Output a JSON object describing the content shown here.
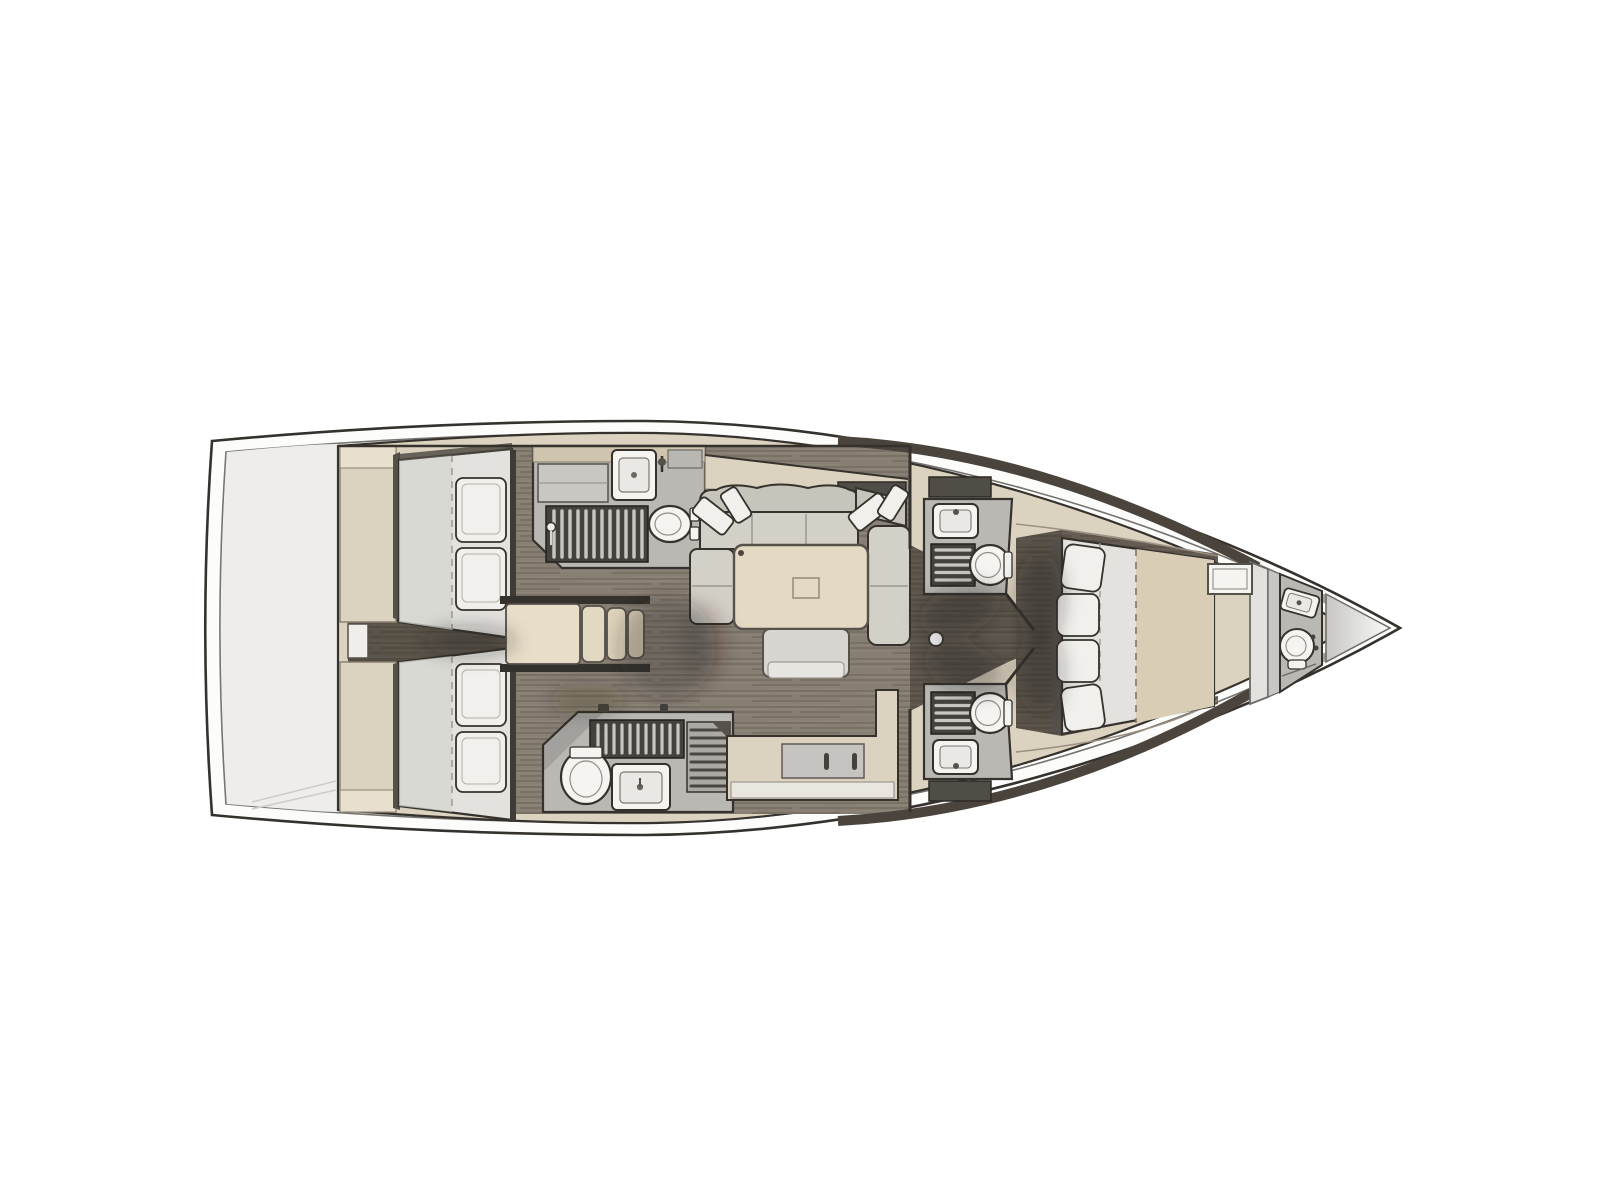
{
  "diagram": {
    "type": "yacht-interior-floor-plan",
    "view": "top-down",
    "orientation": {
      "bow": "right",
      "stern": "left"
    },
    "rooms": [
      {
        "id": "transom",
        "label": "stern-transom-deck",
        "fixtures": []
      },
      {
        "id": "aft-cabin-port",
        "label": "aft-cabin-port",
        "fixtures": [
          "double-berth",
          "pillow",
          "pillow",
          "wardrobe-column"
        ]
      },
      {
        "id": "aft-cabin-starboard",
        "label": "aft-cabin-starboard",
        "fixtures": [
          "double-berth",
          "pillow",
          "pillow",
          "wardrobe-column"
        ]
      },
      {
        "id": "aft-corridor",
        "label": "corridor-between-aft-cabins",
        "fixtures": [
          "wardrobe"
        ]
      },
      {
        "id": "head-aft-port",
        "label": "aft-head-with-shower-port",
        "fixtures": [
          "vanity-sink",
          "cabinet",
          "shower-grate",
          "toilet"
        ]
      },
      {
        "id": "head-aft-starboard",
        "label": "aft-head-with-shower-starboard",
        "fixtures": [
          "shower-grate",
          "bench-grate",
          "toilet",
          "vanity-sink"
        ]
      },
      {
        "id": "companionway",
        "label": "companionway-steps",
        "fixtures": [
          "landing-step",
          "step",
          "step",
          "step"
        ]
      },
      {
        "id": "saloon",
        "label": "saloon",
        "fixtures": [
          "hull-side-shelf",
          "locker",
          "u-shaped-sofa",
          "throw-pillow",
          "throw-pillow",
          "throw-pillow",
          "throw-pillow",
          "dining-table",
          "bench-seat"
        ]
      },
      {
        "id": "galley",
        "label": "galley-counter",
        "fixtures": [
          "l-shaped-counter",
          "appliance-front",
          "handle",
          "handle"
        ]
      },
      {
        "id": "mast-step",
        "label": "mast-compression-post",
        "fixtures": [
          "mast-base"
        ]
      },
      {
        "id": "head-fwd-port",
        "label": "forward-head-port",
        "fixtures": [
          "locker",
          "vanity-sink",
          "shower-grate",
          "toilet"
        ]
      },
      {
        "id": "head-fwd-starboard",
        "label": "forward-head-starboard",
        "fixtures": [
          "locker",
          "vanity-sink",
          "shower-grate",
          "toilet"
        ]
      },
      {
        "id": "owners-cabin",
        "label": "owners-cabin-forward",
        "fixtures": [
          "island-double-berth",
          "bolster-cushion",
          "bolster-cushion",
          "bolster-cushion",
          "bolster-cushion",
          "seat-hatch",
          "wardrobe-partition"
        ]
      },
      {
        "id": "head-bow",
        "label": "bow-head",
        "fixtures": [
          "vanity-sink",
          "toilet"
        ]
      },
      {
        "id": "forepeak",
        "label": "forepeak-anchor-locker",
        "fixtures": []
      }
    ]
  },
  "colors": {
    "paper": "#ffffff",
    "hull_fill": "#fcfcfb",
    "hull_outline": "#2c2b28",
    "deck_line": "#76746e",
    "bow_rim": "#a3a19d",
    "transom": "#eeedeb",
    "interior_beige": "#dcd2c0",
    "beige_shade": "#cfc4ad",
    "beige_light": "#e8e0cf",
    "wall": "#35322d",
    "inner_wall": "#4a443c",
    "floor_wood": "#877e74",
    "floor_grain_dark": "#6e6559",
    "floor_grain_light": "#948b80",
    "bath_floor": "#bab8b3",
    "grate": "#45423d",
    "grate_slat": "#d7d6d1",
    "panel_gray": "#c6c4c0",
    "locker_dark": "#504d47",
    "fixture": "#f5f4f1",
    "mattress": "#e3e2de",
    "pillow": "#f1f0ec",
    "sofa": "#d3d0c7",
    "sofa_back": "#c7c4bb",
    "table": "#e4dac3",
    "bench": "#d7d5d0",
    "bench_light": "#e7e5e0",
    "blanket": "#d9cdb5",
    "shadow": "#241e17",
    "bow_gradient_start": "#c7c6c2",
    "bow_gradient_end": "#fafaf8"
  }
}
